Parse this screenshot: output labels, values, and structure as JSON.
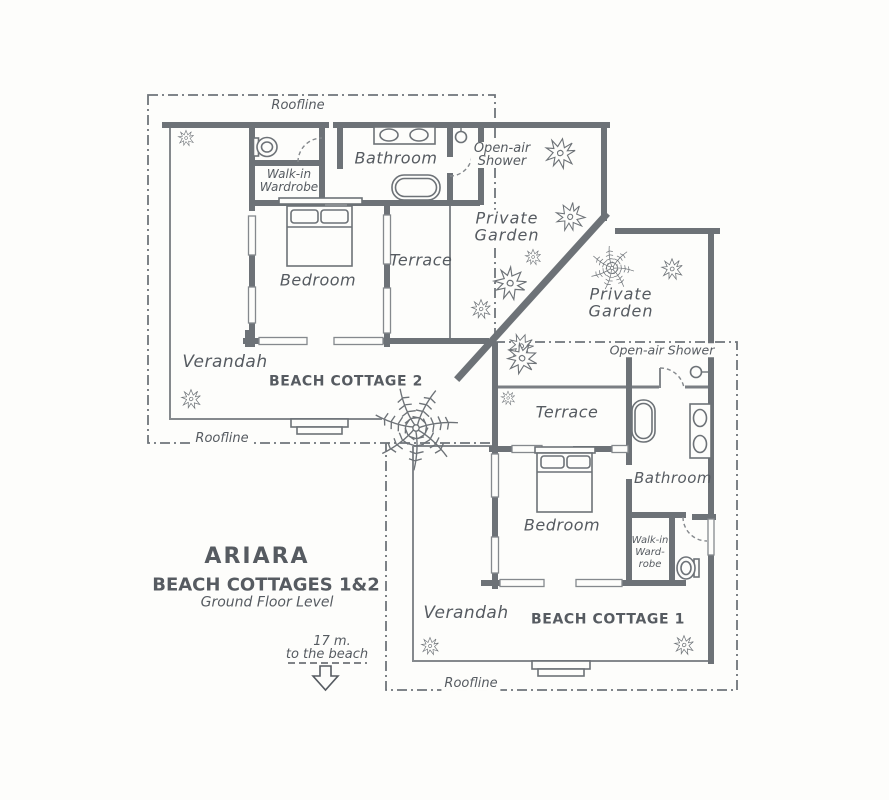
{
  "title": {
    "resort": "ARIARA",
    "subtitle": "BEACH COTTAGES 1&2",
    "level": "Ground Floor Level"
  },
  "beach_note": {
    "distance": "17 m.",
    "direction": "to the beach"
  },
  "roofline_label": "Roofline",
  "cottage2": {
    "name": "BEACH COTTAGE 2",
    "bathroom": "Bathroom",
    "walkin1": "Walk-in",
    "walkin2": "Wardrobe",
    "shower1": "Open-air",
    "shower2": "Shower",
    "garden1": "Private",
    "garden2": "Garden",
    "terrace": "Terrace",
    "bedroom": "Bedroom",
    "verandah": "Verandah"
  },
  "cottage1": {
    "name": "BEACH COTTAGE 1",
    "shower": "Open-air Shower",
    "garden1": "Private",
    "garden2": "Garden",
    "terrace": "Terrace",
    "bathroom": "Bathroom",
    "walkin1": "Walk-in",
    "walkin2": "Ward-",
    "walkin3": "robe",
    "bedroom": "Bedroom",
    "verandah": "Verandah"
  },
  "colors": {
    "wall": "#6d7277",
    "line": "#85898d",
    "text": "#565b61",
    "dash": "#6f747a",
    "paper": "#fdfdfb"
  }
}
